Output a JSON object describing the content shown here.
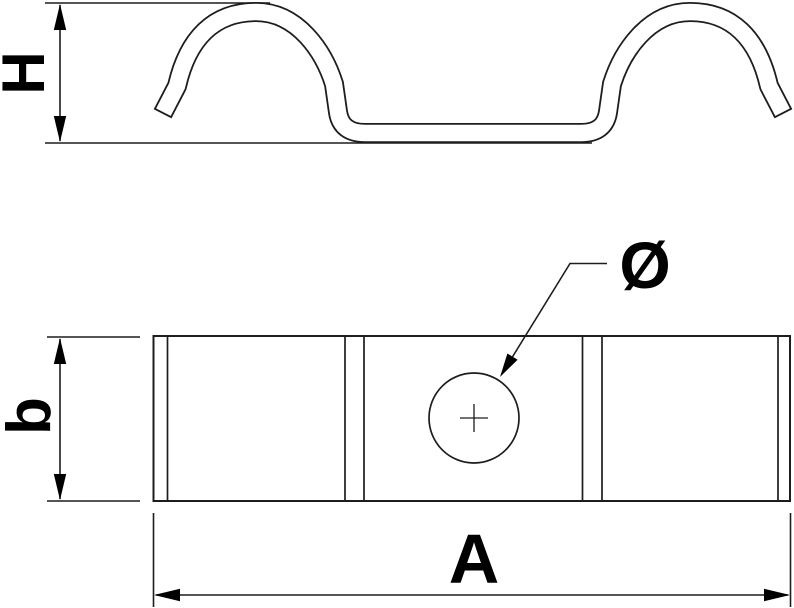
{
  "figure": {
    "kind": "technical dimension drawing, two views of a spring fixing clamp",
    "labels": {
      "height": "H",
      "band_width": "b",
      "length": "A",
      "hole_diameter": "Ø"
    }
  },
  "colors": {
    "line": "#1d1d1d",
    "text": "#000000",
    "background": "#ffffff"
  }
}
